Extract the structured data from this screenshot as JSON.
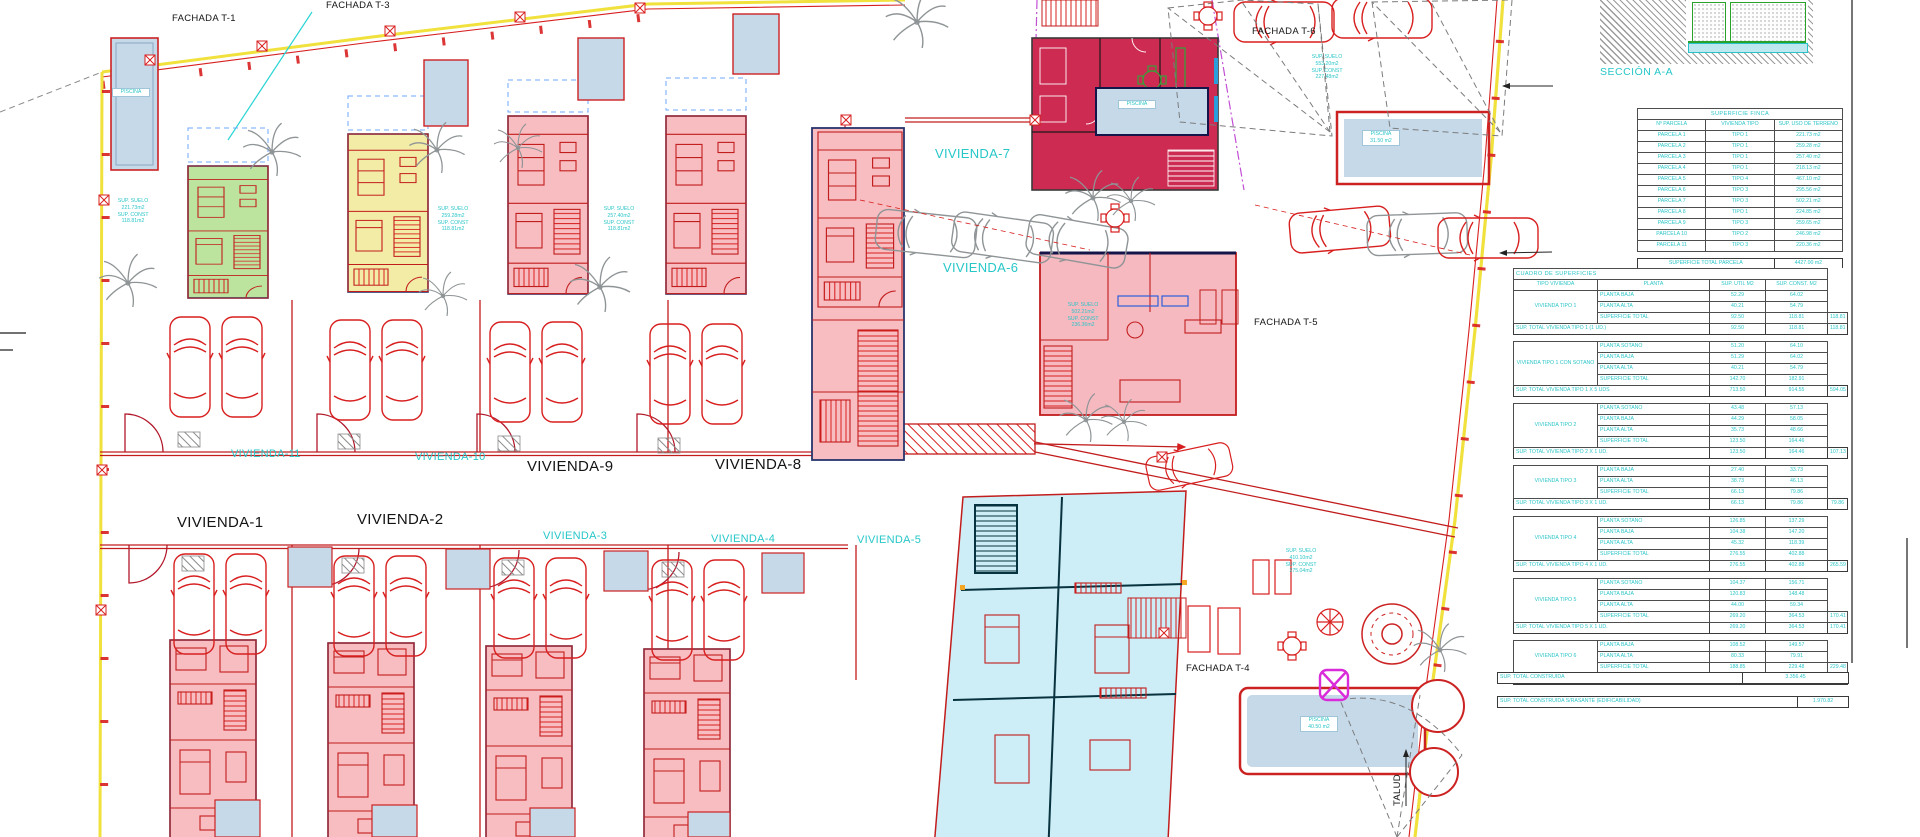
{
  "plan": {
    "labels": {
      "fachada_t1": "FACHADA T-1",
      "fachada_t3": "FACHADA T-3",
      "fachada_t4": "FACHADA T-4",
      "fachada_t5": "FACHADA T-5",
      "fachada_t6": "FACHADA T-6",
      "v1": "VIVIENDA-1",
      "v2": "VIVIENDA-2",
      "v3": "VIVIENDA-3",
      "v4": "VIVIENDA-4",
      "v5": "VIVIENDA-5",
      "v6": "VIVIENDA-6",
      "v7": "VIVIENDA-7",
      "v8": "VIVIENDA-8",
      "v9": "VIVIENDA-9",
      "v10": "VIVIENDA-10",
      "v11": "VIVIENDA-11",
      "talud": "TALUD"
    },
    "annotations": [
      {
        "lines": [
          "SUP. SUELO",
          "221.73m2",
          "SUP. CONST",
          "118.81m2"
        ]
      },
      {
        "lines": [
          "SUP. SUELO",
          "259.28m2",
          "SUP. CONST",
          "118.81m2"
        ]
      },
      {
        "lines": [
          "SUP. SUELO",
          "257.40m2",
          "SUP. CONST",
          "118.81m2"
        ]
      },
      {
        "lines": [
          "SUP. SUELO",
          "553.20m2",
          "SUP. CONST",
          "227.48m2"
        ]
      },
      {
        "lines": [
          "SUP. SUELO",
          "502.21m2",
          "SUP. CONST",
          "236.36m2"
        ]
      },
      {
        "lines": [
          "SUP. SUELO",
          "410.10m2",
          "SUP. CONST",
          "275.04m2"
        ]
      },
      {
        "lines": [
          "PISCINA",
          "31.50 m2"
        ]
      },
      {
        "lines": [
          "PISCINA",
          "40.50 m2"
        ]
      },
      {
        "lines": [
          "PISCINA"
        ]
      },
      {
        "lines": [
          "PISCINA"
        ]
      }
    ],
    "colors": {
      "boundary_yellow": "#f0e13c",
      "cad_red": "#d81f1f",
      "cad_cyan": "#27c7c9",
      "highlight_crimson": "#ce2b52",
      "unit_pink": "#f7bdc1",
      "unit_green": "#bce49e",
      "unit_yellow": "#f3eca6",
      "unit_cyan": "#cdeef6",
      "pool_blue": "#c6d9e9",
      "magenta": "#d92bd9"
    }
  },
  "section_detail": {
    "label": "SECCIÓN A-A"
  },
  "tables": {
    "finca": {
      "title": "SUPERFICIE FINCA",
      "headers": [
        "Nº PARCELA",
        "VIVIENDA TIPO",
        "SUP. USO DE TERRENO"
      ],
      "rows": [
        [
          "PARCELA 1",
          "TIPO 1",
          "221.73 m2"
        ],
        [
          "PARCELA 2",
          "TIPO 1",
          "259.28 m2"
        ],
        [
          "PARCELA 3",
          "TIPO 1",
          "257.40 m2"
        ],
        [
          "PARCELA 4",
          "TIPO 1",
          "218.13 m2"
        ],
        [
          "PARCELA 5",
          "TIPO 4",
          "467.10 m2"
        ],
        [
          "PARCELA 6",
          "TIPO 3",
          "295.56 m2"
        ],
        [
          "PARCELA 7",
          "TIPO 3",
          "502.21 m2"
        ],
        [
          "PARCELA 8",
          "TIPO 1",
          "224.85 m2"
        ],
        [
          "PARCELA 9",
          "TIPO 3",
          "259.65 m2"
        ],
        [
          "PARCELA 10",
          "TIPO 2",
          "246.98 m2"
        ],
        [
          "PARCELA 11",
          "TIPO 3",
          "220.36 m2"
        ]
      ],
      "footer": [
        "SUPERFICIE TOTAL PARCELA",
        "4427.00 m2"
      ]
    },
    "cuadro": {
      "title": "CUADRO DE SUPERFICIES",
      "headers": [
        "TIPO VIVIENDA",
        "PLANTA",
        "SUP. UTIL M2",
        "SUP. CONST. M2"
      ],
      "note": [
        "EDIFICABILIDAD",
        "SUP. CONST.",
        "SOBRE RASANTE"
      ],
      "sections": [
        {
          "tipo": "VIVIENDA TIPO 1",
          "rows": [
            [
              "PLANTA BAJA",
              "52.29",
              "64.02",
              ""
            ],
            [
              "PLANTA ALTA",
              "40.21",
              "54.79",
              ""
            ],
            [
              "SUPERFICIE TOTAL",
              "92.50",
              "118.81",
              "118.81"
            ]
          ],
          "total": [
            "SUP. TOTAL VIVIENDA TIPO 1 (1 UD.)",
            "92.50",
            "118.81",
            "118.81"
          ]
        },
        {
          "tipo": "VIVIENDA TIPO 1 CON SOTANO",
          "rows": [
            [
              "PLANTA SOTANO",
              "51.20",
              "64.10",
              ""
            ],
            [
              "PLANTA BAJA",
              "51.29",
              "64.02",
              ""
            ],
            [
              "PLANTA ALTA",
              "40.21",
              "54.79",
              ""
            ],
            [
              "SUPERFICIE TOTAL",
              "142.70",
              "182.91",
              ""
            ]
          ],
          "total": [
            "SUP. TOTAL VIVIENDA TIPO 1 X 5 UDS",
            "713.50",
            "914.55",
            "594.05"
          ]
        },
        {
          "tipo": "VIVIENDA TIPO 2",
          "rows": [
            [
              "PLANTA SOTANO",
              "43.48",
              "57.13",
              ""
            ],
            [
              "PLANTA BAJA",
              "44.29",
              "58.05",
              ""
            ],
            [
              "PLANTA ALTA",
              "35.73",
              "48.66",
              ""
            ],
            [
              "SUPERFICIE TOTAL",
              "123.50",
              "164.46",
              ""
            ]
          ],
          "total": [
            "SUP. TOTAL VIVIENDA TIPO 2 X 1 UD.",
            "123.50",
            "164.46",
            "107.13"
          ]
        },
        {
          "tipo": "VIVIENDA TIPO 3",
          "rows": [
            [
              "PLANTA BAJA",
              "27.40",
              "33.73",
              ""
            ],
            [
              "PLANTA ALTA",
              "38.73",
              "46.13",
              ""
            ],
            [
              "SUPERFICIE TOTAL",
              "66.13",
              "79.86",
              ""
            ]
          ],
          "total": [
            "SUP. TOTAL VIVIENDA TIPO 3 X 1 UD.",
            "66.13",
            "79.86",
            "79.86"
          ]
        },
        {
          "tipo": "VIVIENDA TIPO 4",
          "rows": [
            [
              "PLANTA SOTANO",
              "126.85",
              "137.29",
              ""
            ],
            [
              "PLANTA BAJA",
              "104.38",
              "147.20",
              ""
            ],
            [
              "PLANTA ALTA",
              "45.32",
              "118.39",
              ""
            ],
            [
              "SUPERFICIE TOTAL",
              "276.55",
              "402.88",
              ""
            ]
          ],
          "total": [
            "SUP. TOTAL VIVIENDA TIPO 4 X 1 UD.",
            "276.55",
            "402.88",
            "265.59"
          ]
        },
        {
          "tipo": "VIVIENDA TIPO 5",
          "rows": [
            [
              "PLANTA SOTANO",
              "104.37",
              "156.71",
              ""
            ],
            [
              "PLANTA BAJA",
              "120.83",
              "148.48",
              ""
            ],
            [
              "PLANTA ALTA",
              "44.00",
              "59.34",
              ""
            ],
            [
              "SUPERFICIE TOTAL",
              "269.20",
              "364.53",
              "170.41"
            ]
          ],
          "total": [
            "SUP. TOTAL VIVIENDA TIPO 5 X 1 UD.",
            "269.20",
            "364.53",
            "170.41"
          ]
        },
        {
          "tipo": "VIVIENDA TIPO 6",
          "rows": [
            [
              "PLANTA BAJA",
              "108.52",
              "149.57",
              ""
            ],
            [
              "PLANTA ALTA",
              "80.33",
              "79.91",
              ""
            ],
            [
              "SUPERFICIE TOTAL",
              "188.85",
              "229.48",
              "229.48"
            ]
          ],
          "total": [
            "SUP. TOTAL VIVIENDA TIPO 6 X 1 UD.",
            "188.85",
            "229.48",
            "229.48"
          ]
        }
      ],
      "summary": [
        [
          "SUP. TOTAL CONSTRUIDA",
          "3.356.45"
        ],
        [
          "SUP. TOTAL CONSTRUIDA S/RASANTE (EDIFICABILIDAD)",
          "1.970.82"
        ]
      ]
    }
  }
}
